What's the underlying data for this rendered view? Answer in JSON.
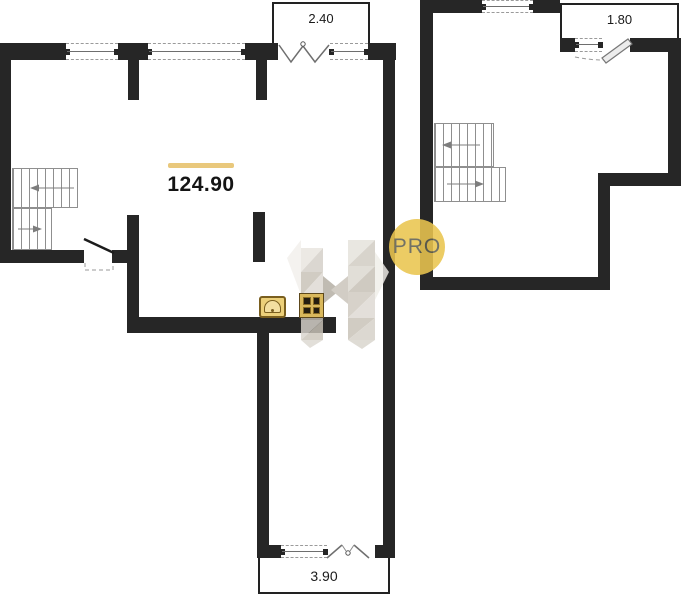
{
  "plan": {
    "area_label": "124.90",
    "balconies": {
      "top": "2.40",
      "right": "1.80",
      "bottom": "3.90"
    }
  },
  "watermark": {
    "badge_text": "PRO"
  },
  "colors": {
    "wall": "#262626",
    "accent": "#e9c87c",
    "badge": "#eac54f",
    "badge_text": "#5f5f52",
    "fixture_gold": "#d9b85c",
    "fixture_outline": "#7a5f1f"
  },
  "icons": {
    "kitchen_fixtures": [
      "sink-icon",
      "stove-icon"
    ],
    "watermark": [
      "letter-h-watermark",
      "pro-badge"
    ]
  }
}
